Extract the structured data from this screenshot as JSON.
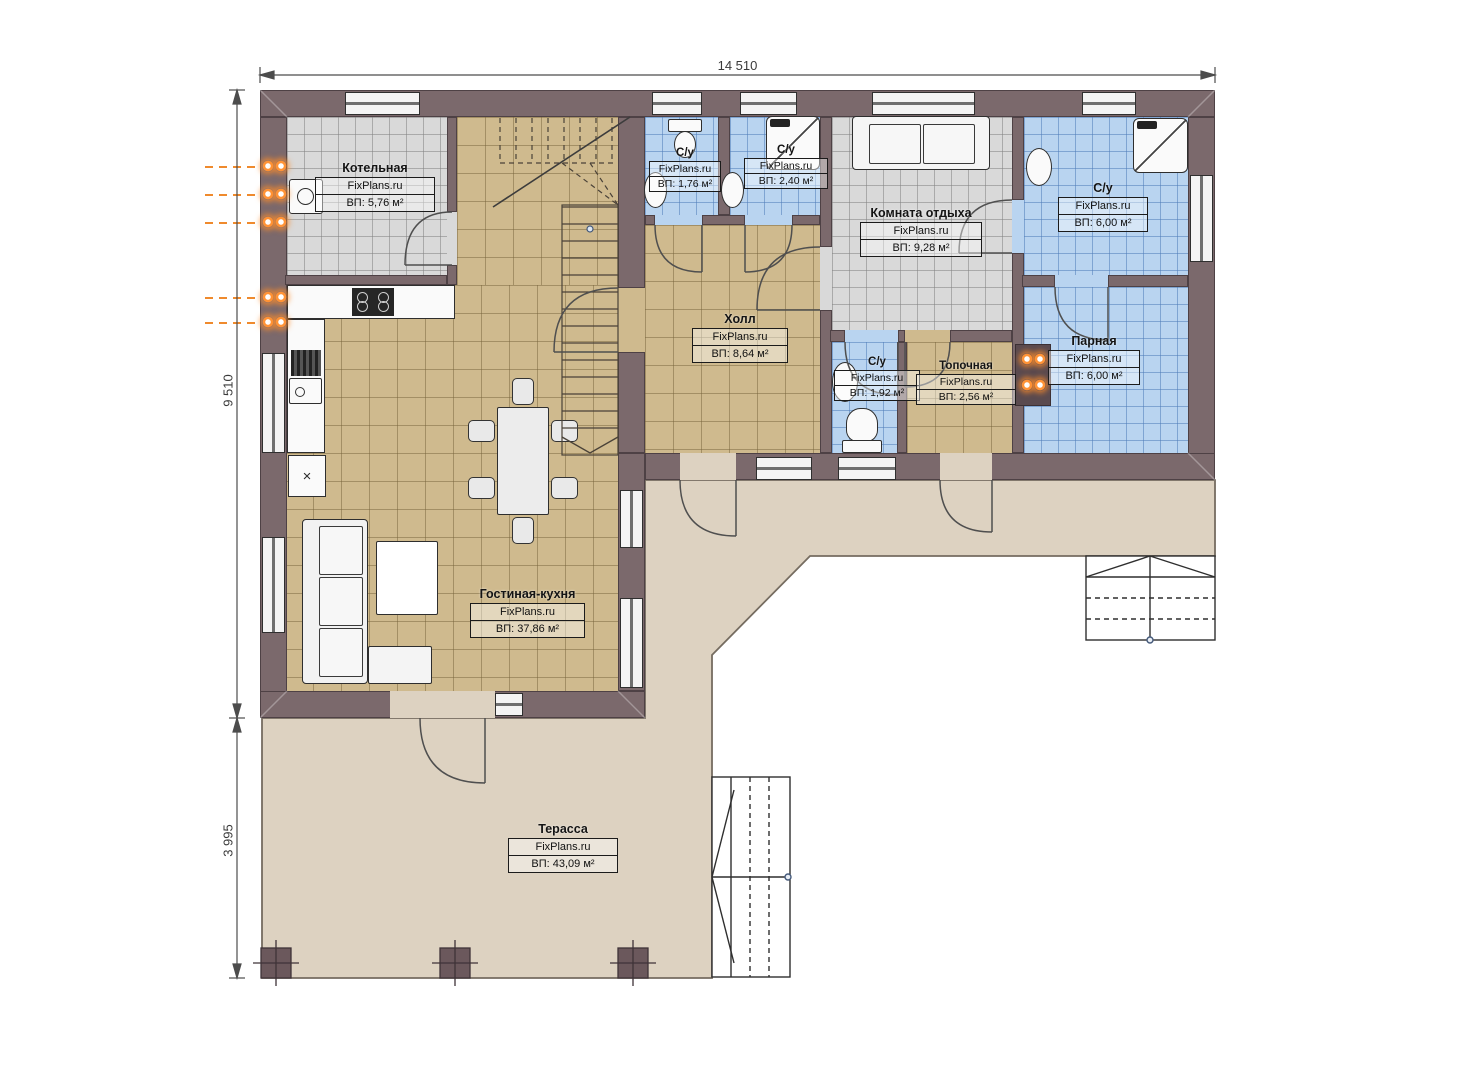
{
  "brand": "FixPlans.ru",
  "dimensions": {
    "top": "14 510",
    "left_upper": "9 510",
    "left_lower": "3 995"
  },
  "rooms": [
    {
      "name": "Котельная",
      "area": "ВП: 5,76 м²"
    },
    {
      "name": "С/у",
      "area": "ВП: 1,76 м²"
    },
    {
      "name": "С/у",
      "area": "ВП: 2,40 м²"
    },
    {
      "name": "Комната отдыха",
      "area": "ВП: 9,28 м²"
    },
    {
      "name": "С/у",
      "area": "ВП: 6,00 м²"
    },
    {
      "name": "Холл",
      "area": "ВП: 8,64 м²"
    },
    {
      "name": "С/у",
      "area": "ВП: 1,92 м²"
    },
    {
      "name": "Топочная",
      "area": "ВП: 2,56 м²"
    },
    {
      "name": "Парная",
      "area": "ВП: 6,00 м²"
    },
    {
      "name": "Гостиная-кухня",
      "area": "ВП: 37,86 м²"
    },
    {
      "name": "Терасса",
      "area": "ВП: 43,09 м²"
    }
  ],
  "kitchen": {
    "unit_glyph": "×"
  },
  "colors": {
    "wall": "#7b696c",
    "floor_tan": "#cfba8e",
    "floor_gray": "#d9d9d9",
    "floor_blue": "#b9d4f0",
    "terrace": "#ddd2c1",
    "radiator_accent": "#ff9336"
  }
}
